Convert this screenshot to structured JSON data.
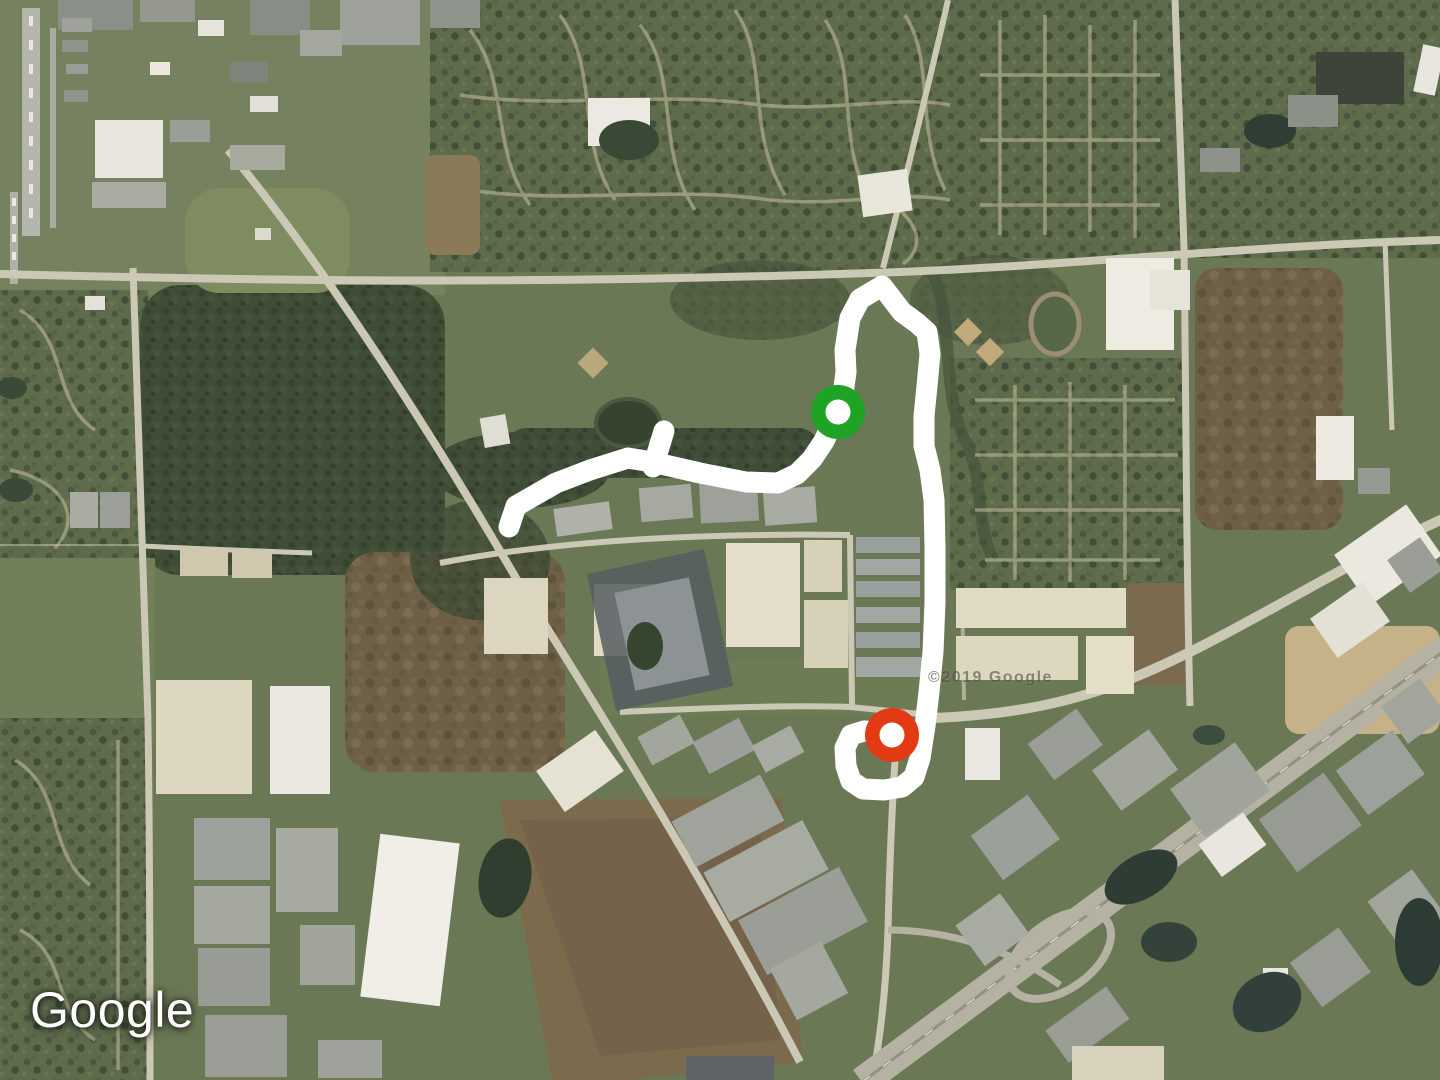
{
  "map": {
    "provider_logo": "Google",
    "imagery_watermark": "©2019 Google"
  },
  "route": {
    "color": "#ffffff",
    "stroke_width": 21,
    "main_path": [
      [
        509,
        527
      ],
      [
        516,
        506
      ],
      [
        556,
        483
      ],
      [
        590,
        470
      ],
      [
        628,
        458
      ],
      [
        652,
        462
      ],
      [
        700,
        473
      ],
      [
        746,
        482
      ],
      [
        778,
        483
      ],
      [
        797,
        474
      ],
      [
        812,
        459
      ],
      [
        824,
        441
      ],
      [
        832,
        424
      ],
      [
        838,
        410
      ],
      [
        843,
        394
      ],
      [
        846,
        372
      ],
      [
        845,
        350
      ],
      [
        850,
        318
      ],
      [
        860,
        299
      ],
      [
        882,
        286
      ],
      [
        902,
        312
      ],
      [
        917,
        323
      ],
      [
        927,
        332
      ],
      [
        930,
        354
      ],
      [
        927,
        386
      ],
      [
        924,
        416
      ],
      [
        924,
        446
      ],
      [
        930,
        470
      ],
      [
        934,
        500
      ],
      [
        935,
        548
      ],
      [
        935,
        602
      ],
      [
        933,
        652
      ],
      [
        929,
        692
      ],
      [
        925,
        726
      ],
      [
        920,
        758
      ],
      [
        914,
        777
      ],
      [
        902,
        787
      ],
      [
        884,
        790
      ],
      [
        863,
        789
      ],
      [
        851,
        781
      ],
      [
        846,
        766
      ],
      [
        845,
        748
      ],
      [
        851,
        735
      ],
      [
        864,
        731
      ],
      [
        885,
        732
      ]
    ],
    "spur_path": [
      [
        653,
        467
      ],
      [
        664,
        431
      ]
    ],
    "start_marker": {
      "x": 838,
      "y": 412,
      "color": "#1fa324",
      "outer_radius": 27,
      "inner_radius": 12.5,
      "inner_color": "#ffffff"
    },
    "end_marker": {
      "x": 892,
      "y": 735,
      "color": "#e23a13",
      "outer_radius": 27,
      "inner_radius": 12.5,
      "inner_color": "#ffffff"
    }
  }
}
